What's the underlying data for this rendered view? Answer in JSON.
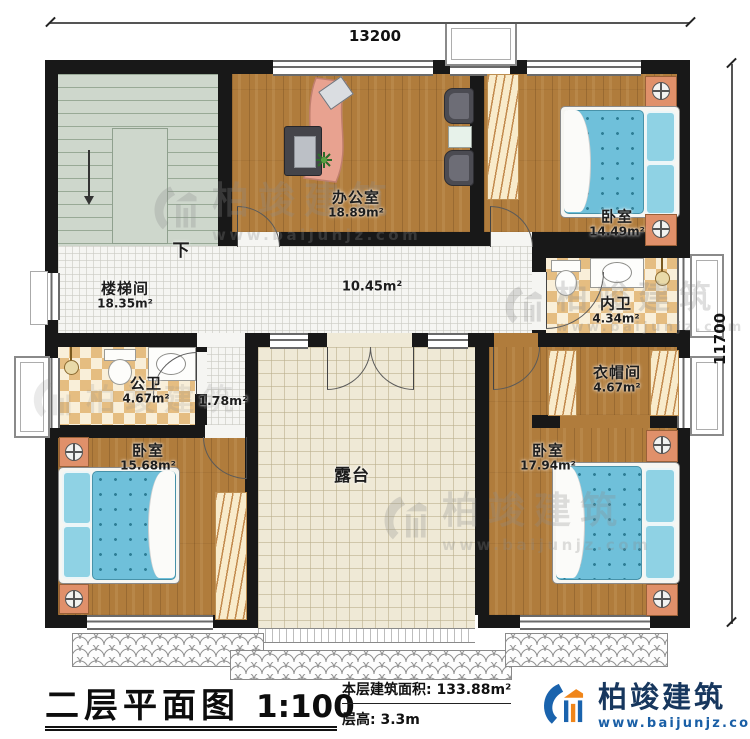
{
  "dimensions": {
    "top": "13200",
    "right": "11700"
  },
  "rooms": {
    "stairwell": {
      "name": "楼梯间",
      "area": "18.35m²"
    },
    "corridor": {
      "area": "10.45m²"
    },
    "office": {
      "name": "办公室",
      "area": "18.89m²"
    },
    "bedroom_ne": {
      "name": "卧室",
      "area": "14.49m²"
    },
    "inner_bath": {
      "name": "内卫",
      "area": "4.34m²"
    },
    "cloakroom": {
      "name": "衣帽间",
      "area": "4.67m²"
    },
    "public_bath": {
      "name": "公卫",
      "area": "4.67m²"
    },
    "hallway": {
      "area": "1.78m²"
    },
    "bedroom_sw": {
      "name": "卧室",
      "area": "15.68m²"
    },
    "bedroom_se": {
      "name": "卧室",
      "area": "17.94m²"
    },
    "terrace": {
      "name": "露台"
    },
    "stair_down": "下"
  },
  "titleblock": {
    "title": "二层平面图",
    "scale": "1:100",
    "area_label": "本层建筑面积:",
    "area_value": "133.88m²",
    "height_label": "层高:",
    "height_value": "3.3m"
  },
  "brand": {
    "name": "柏竣建筑",
    "url": "www.baijunjz.com"
  },
  "watermark": {
    "name": "柏竣建筑",
    "url": "www.baijunjz.com"
  },
  "colors": {
    "wall": "#181818",
    "wood_floor": "#b07c3c",
    "stair": "#ced7cc",
    "terrace_tile": "#efe9d6",
    "bath_tile": "#e5bd81",
    "mattress": "#6fc0da",
    "brand_blue": "#1a5fa6",
    "brand_orange": "#f08519"
  }
}
